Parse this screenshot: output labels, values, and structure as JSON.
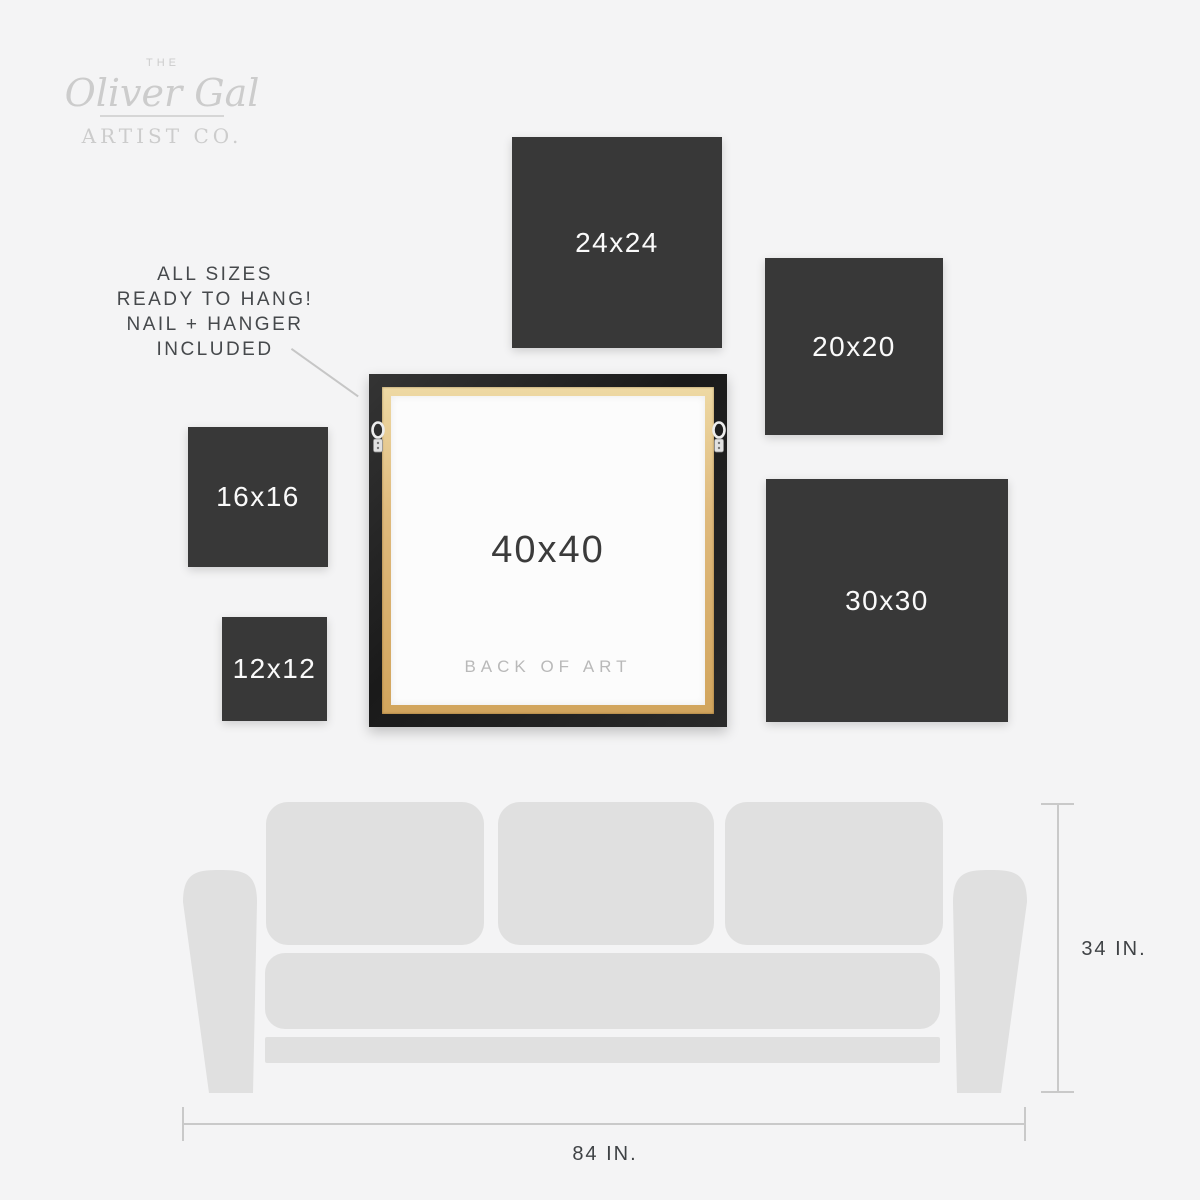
{
  "logo": {
    "the": "THE",
    "script": "Oliver Gal",
    "subtitle": "ARTIST CO."
  },
  "info_note": {
    "lines": [
      "ALL SIZES",
      "READY TO HANG!",
      "NAIL + HANGER",
      "INCLUDED"
    ]
  },
  "size_squares": [
    {
      "label": "24x24"
    },
    {
      "label": "20x20"
    },
    {
      "label": "16x16"
    },
    {
      "label": "12x12"
    },
    {
      "label": "30x30"
    }
  ],
  "frame": {
    "label": "40x40",
    "caption": "BACK OF ART"
  },
  "dimensions": {
    "height_label": "34 IN.",
    "width_label": "84 IN."
  },
  "icons": {
    "hangers": "d-ring-hanger"
  },
  "colors": {
    "background": "#f4f4f5",
    "square_fill": "#383838",
    "square_label": "#fafafa",
    "sofa_fill": "#e0e0e0",
    "frame_black": "#212121",
    "wood": "#dfba7d",
    "canvas_back": "#fcfcfc",
    "caption_gray": "#b9b9b9",
    "line_gray": "#c9c9c9",
    "text_dark": "#46494c",
    "logo_gray": "#cccccc"
  }
}
